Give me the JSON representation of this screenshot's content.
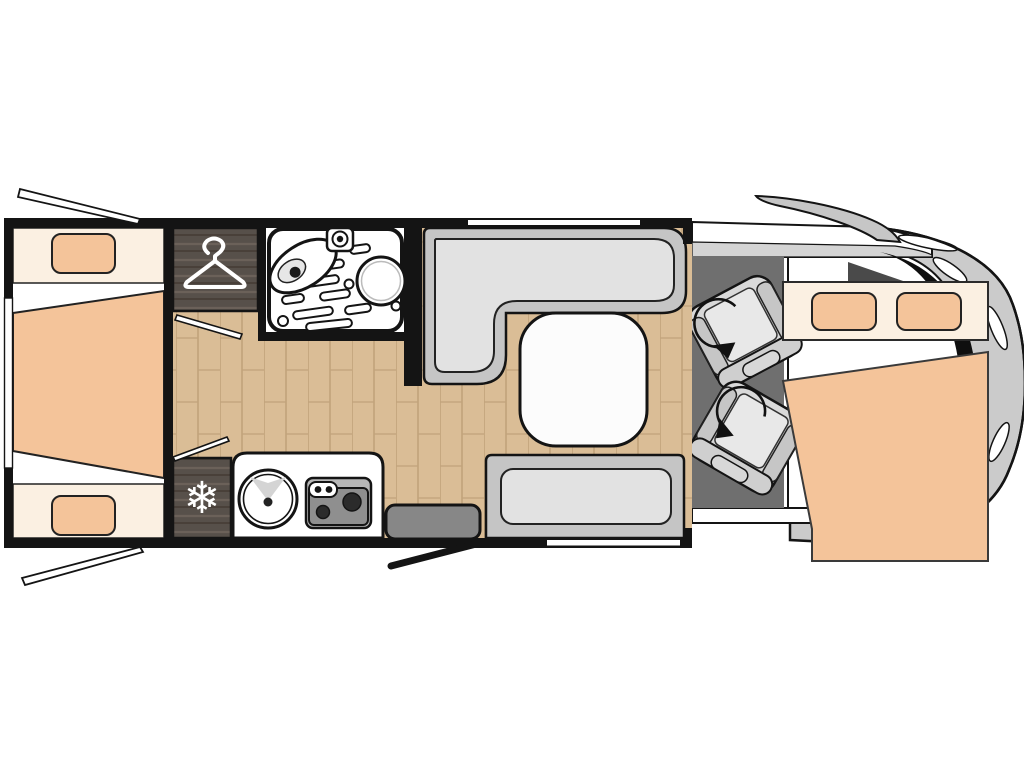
{
  "floorplan": {
    "type": "motorhome-top-view-floorplan",
    "icons": {
      "snowflake_glyph": "❄",
      "hanger": "clothes-hanger-icon",
      "swivel_arrow": "rotate-arrow-icon"
    },
    "features": {
      "swivel_seats": 2,
      "pillows": 4,
      "beds": 2,
      "burners": 2
    },
    "colors": {
      "wall": "#141414",
      "wood_floor": "#dabd96",
      "wood_seam": "#c1a37b",
      "dark_wood": "#57504a",
      "dark_wood_grain": "#6b6159",
      "bed_cream": "#fbf0e2",
      "mattress": "#f4c49a",
      "bench": "#c5c5c5",
      "bench_cushion": "#e2e2e2",
      "table": "#fcfcfc",
      "cab_floor": "#6f6f6f",
      "seat_base": "#d9d9d9",
      "seat_cushion": "#e8e8e8",
      "seat_back": "#cfcfcf",
      "cap_body": "#cbcbcb",
      "cap_dark": "#0f0f0f",
      "mirror": "#c6c6c6",
      "sill_gray": "#d4d4d4",
      "step": "#878787",
      "stove": "#b7b7b7",
      "cooktop": "#8f8f8f",
      "burner": "#2b2b2b",
      "fixture_white": "#ffffff",
      "pillar": "#4a4a4a"
    }
  }
}
